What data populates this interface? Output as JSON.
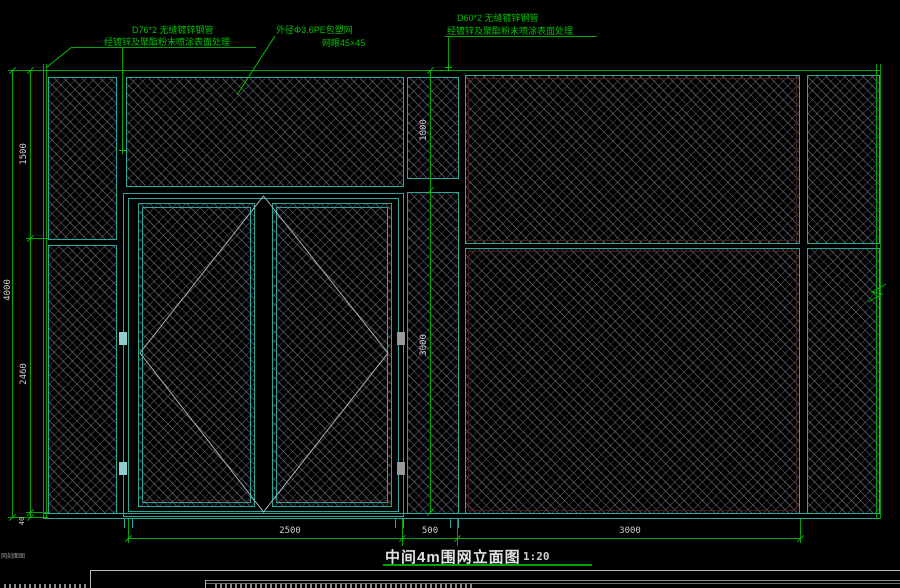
{
  "drawing": {
    "title": "中间4m围网立面图",
    "scale": "1:20",
    "corner_label": "网剖面图",
    "annotations": {
      "left_pipe_line1": "D76*2 无缝镀锌钢管",
      "left_pipe_line2": "经镀锌及聚酯粉末喷涂表面处理",
      "mesh_line1": "外径Φ3.6PE包塑网",
      "mesh_line2": "网眼45×45",
      "right_pipe_line1": "D60*2 无缝镀锌钢管",
      "right_pipe_line2": "经镀锌及聚酯粉末喷涂表面处理"
    },
    "dimensions": {
      "total_height": "4000",
      "top_height": "1500",
      "mid_height": "2460",
      "base_height": "40",
      "band_height": "1000",
      "gate_height": "3000",
      "gate_width": "2500",
      "post_width": "500",
      "panel_width": "3000"
    },
    "colors": {
      "background": "#000000",
      "frame_teal": "#2aa79a",
      "dimension_green": "#00a400",
      "annotation_green": "#00c200",
      "dim_text": "#cfcfcf",
      "title_text": "#e2e2e2",
      "mesh_line": "#80868c",
      "diamond_line": "#a8b4b4",
      "accent_red": "#4a1c1c"
    }
  }
}
